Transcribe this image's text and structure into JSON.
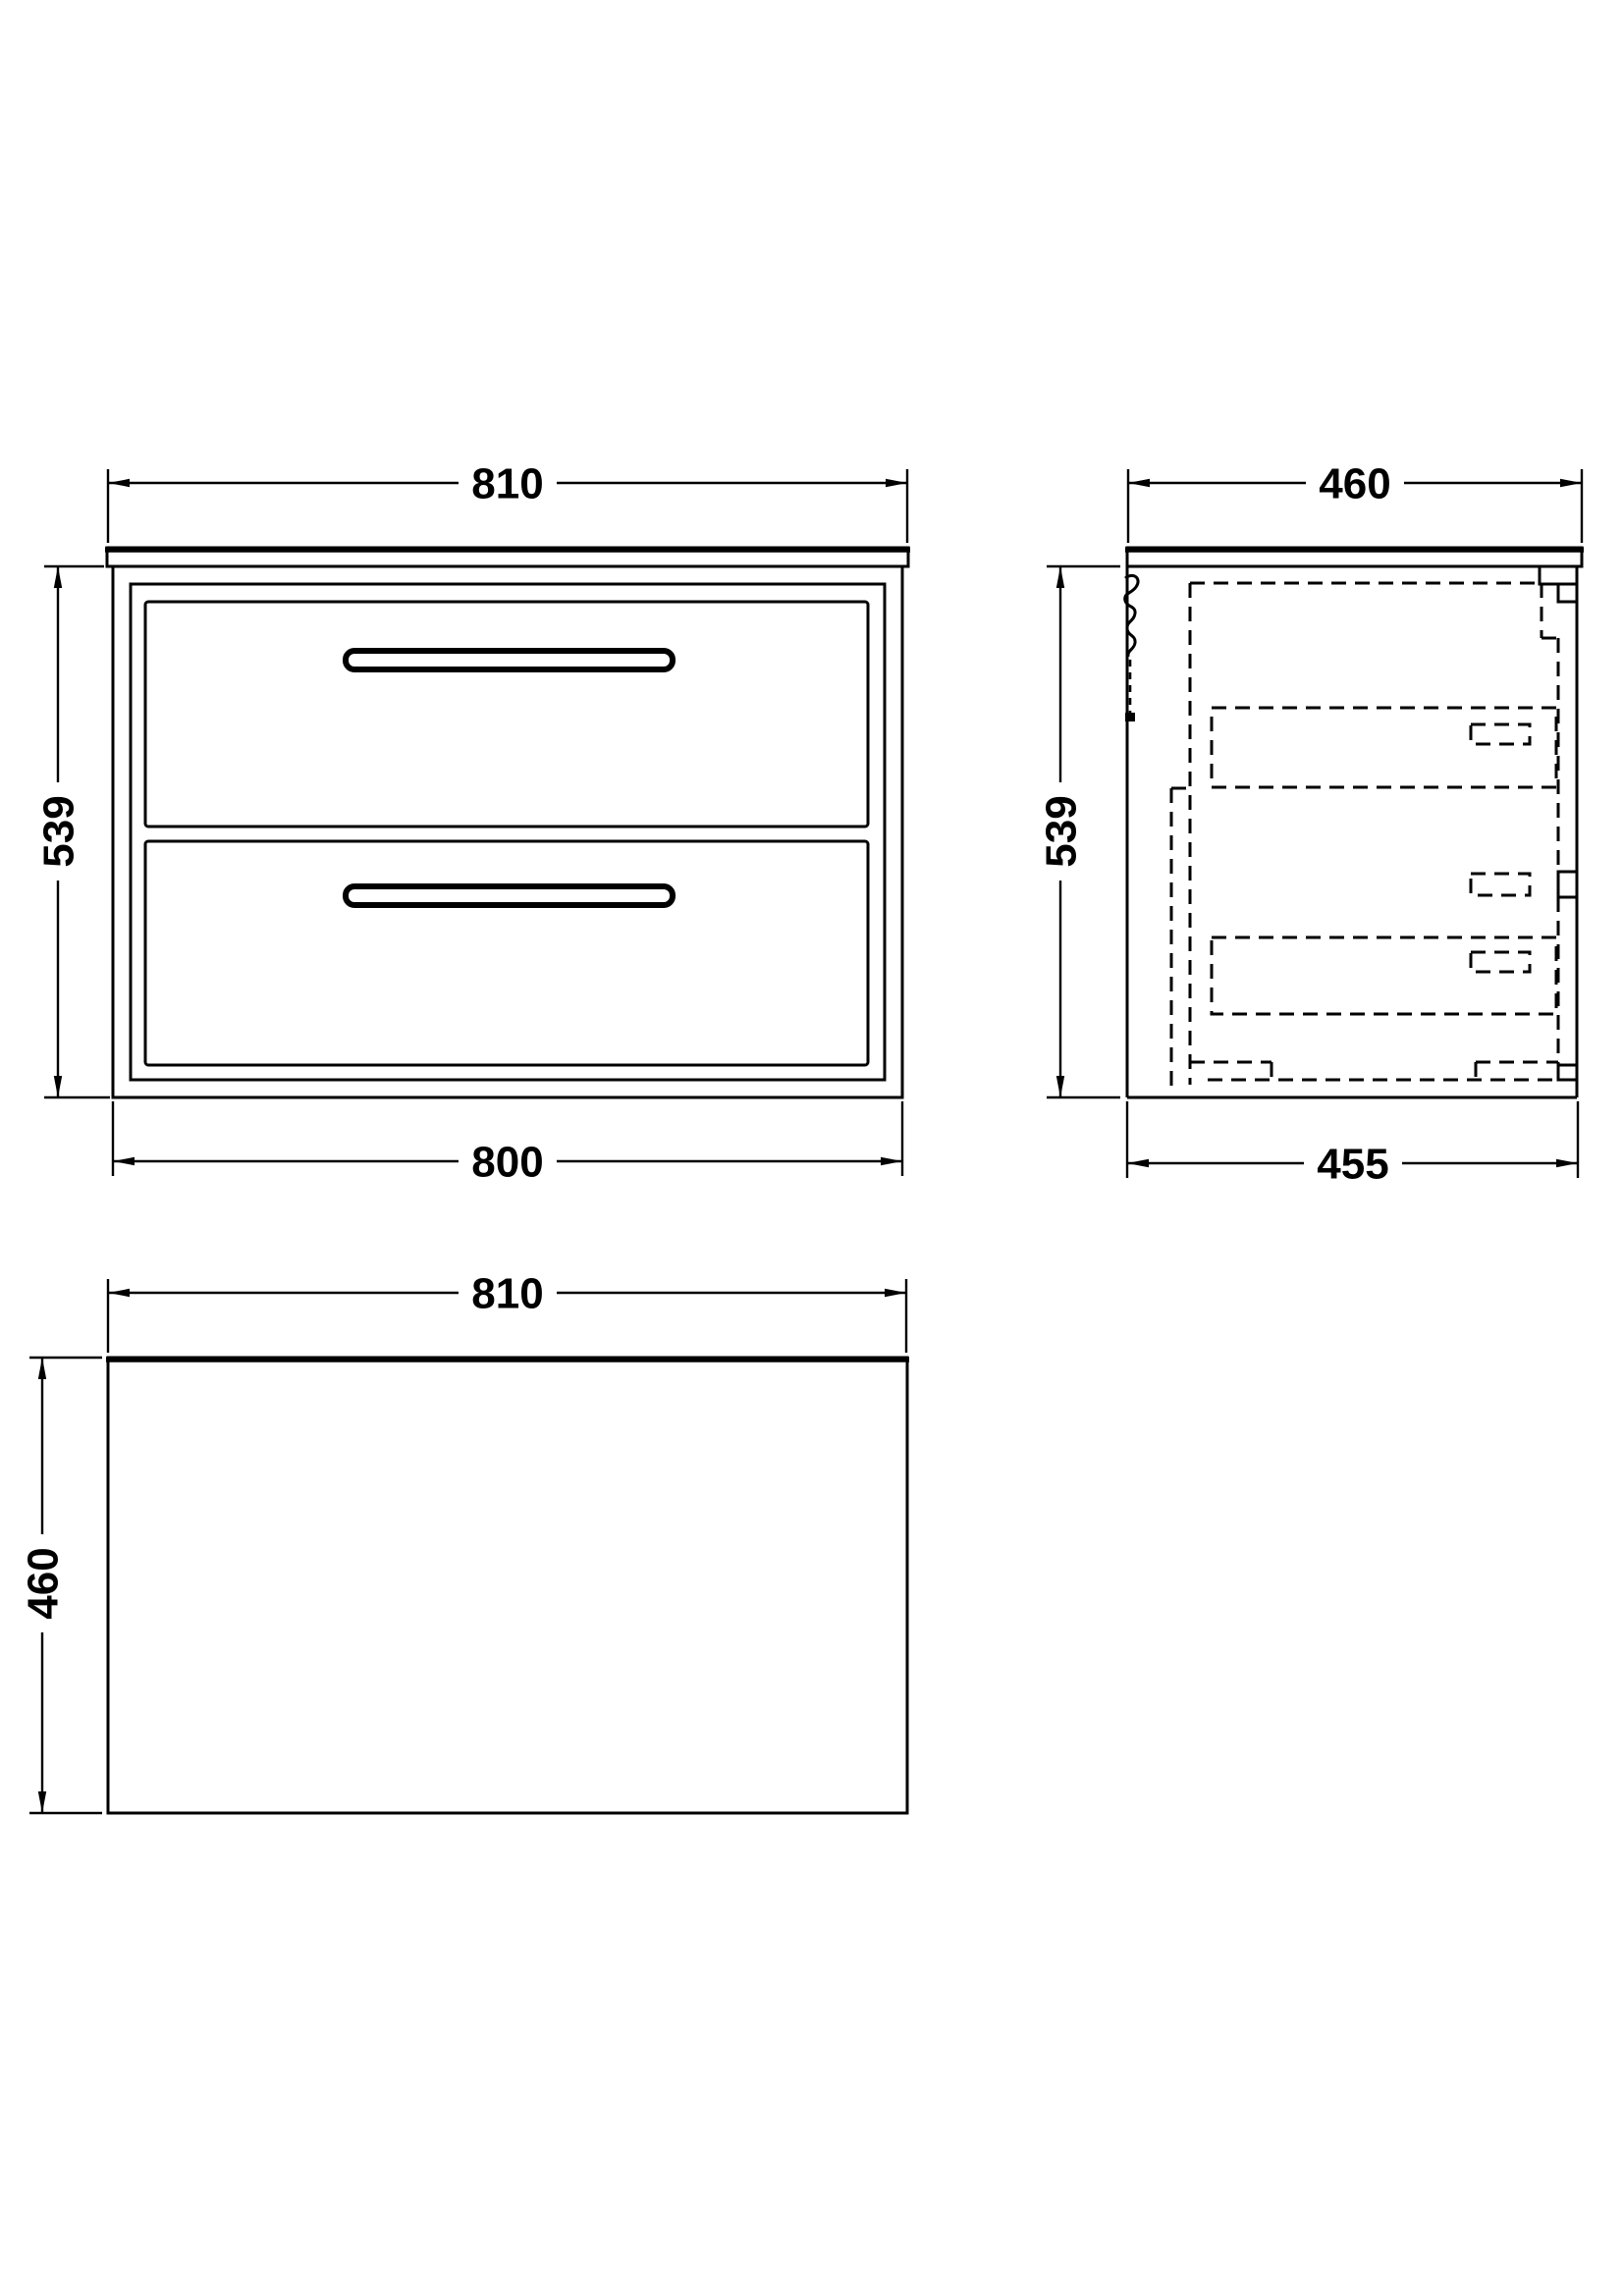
{
  "colors": {
    "ink": "#000000",
    "paper": "#ffffff"
  },
  "views": {
    "front": {
      "width_top": "810",
      "height": "539",
      "width_bottom": "800"
    },
    "side": {
      "depth_top": "460",
      "height": "539",
      "depth_bottom": "455"
    },
    "plan": {
      "width_top": "810",
      "depth": "460"
    }
  }
}
